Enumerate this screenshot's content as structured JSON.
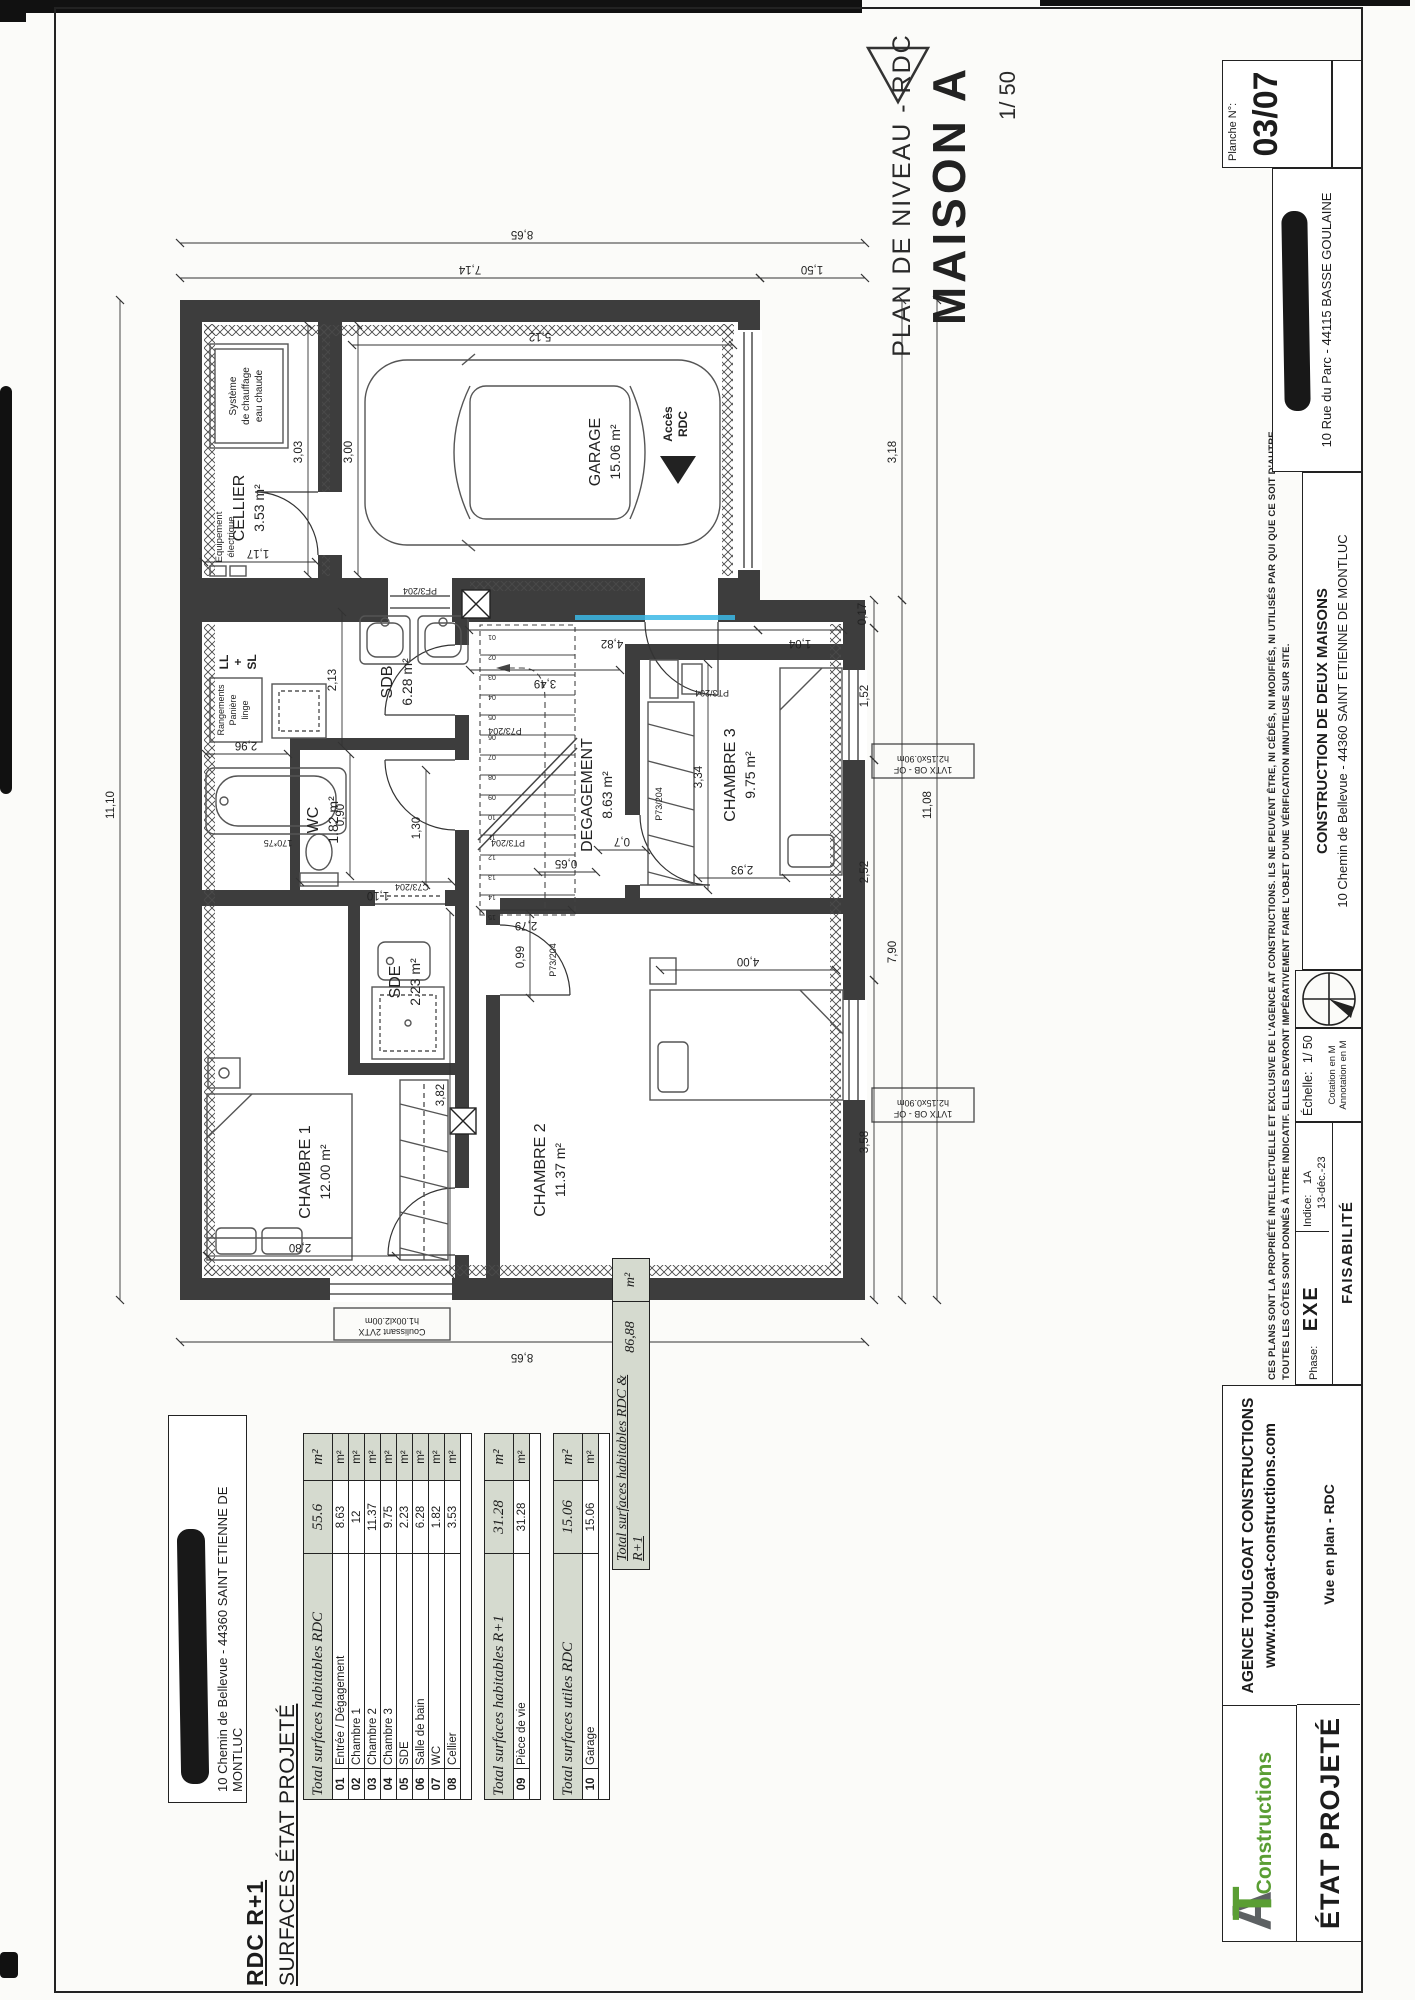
{
  "page": {
    "title_line": "PLAN DE NIVEAU - RDC",
    "title_main": "MAISON A",
    "scale": "1/ 50",
    "planche_label": "Planche N°:",
    "planche_no": "03/07",
    "agency_address": "10 Rue du Parc - 44115 BASSE GOULAINE"
  },
  "title_block": {
    "agency_name": "AGENCE TOULGOAT CONSTRUCTIONS",
    "agency_site": "www.toulgoat-constructions.com",
    "logo_a": "A",
    "logo_t": "T",
    "logo_text": "Constructions",
    "etat": "ÉTAT PROJETÉ",
    "vue": "Vue en plan - RDC",
    "phase_label": "Phase:",
    "phase": "EXE",
    "status": "FAISABILITÉ",
    "indice_label": "Indice:",
    "indice": "1A",
    "indice_date": "13-déc.-23",
    "echelle_label": "Échelle:",
    "echelle": "1/ 50",
    "cotation": "Cotation en M",
    "annotation": "Annotation en M",
    "project_title": "CONSTRUCTION DE DEUX MAISONS",
    "project_address": "10 Chemin de Bellevue - 44360 SAINT ETIENNE DE MONTLUC",
    "disclaimer1": "CES PLANS SONT LA PROPRIÉTÉ INTELLECTUELLE ET EXCLUSIVE DE L'AGENCE AT CONSTRUCTIONS. ILS NE PEUVENT ÊTRE, NI CÉDÉS, NI MODIFIÉS, NI UTILISÉS PAR QUI QUE CE SOIT D'AUTRE.",
    "disclaimer2": "TOUTES LES CÔTES SONT DONNÉS À TITRE INDICATIF. ELLES DEVRONT IMPÉRATIVEMENT FAIRE L'OBJET D'UNE VÉRIFICATION MINUTIEUSE SUR SITE."
  },
  "surfaces": {
    "heading1": "RDC  R+1",
    "heading2": "SURFACES ÉTAT PROJETÉ",
    "client_address": "10 Chemin de Bellevue - 44360 SAINT ETIENNE DE MONTLUC",
    "tables": [
      {
        "title": "Total surfaces habitables RDC",
        "total": "55.6",
        "unit": "m²",
        "rows": [
          {
            "num": "01",
            "label": "Entrée / Dégagement",
            "value": "8.63",
            "unit": "m²"
          },
          {
            "num": "02",
            "label": "Chambre 1",
            "value": "12",
            "unit": "m²"
          },
          {
            "num": "03",
            "label": "Chambre 2",
            "value": "11.37",
            "unit": "m²"
          },
          {
            "num": "04",
            "label": "Chambre 3",
            "value": "9.75",
            "unit": "m²"
          },
          {
            "num": "05",
            "label": "SDE",
            "value": "2.23",
            "unit": "m²"
          },
          {
            "num": "06",
            "label": "Salle de bain",
            "value": "6.28",
            "unit": "m²"
          },
          {
            "num": "07",
            "label": "WC",
            "value": "1.82",
            "unit": "m²"
          },
          {
            "num": "08",
            "label": "Cellier",
            "value": "3.53",
            "unit": "m²"
          }
        ]
      },
      {
        "title": "Total surfaces habitables R+1",
        "total": "31.28",
        "unit": "m²",
        "rows": [
          {
            "num": "09",
            "label": "Pièce de vie",
            "value": "31.28",
            "unit": "m²"
          }
        ]
      },
      {
        "title": "Total surfaces utiles RDC",
        "total": "15.06",
        "unit": "m²",
        "rows": [
          {
            "num": "10",
            "label": "Garage",
            "value": "15.06",
            "unit": "m²"
          }
        ]
      }
    ],
    "grand_total": {
      "label": "Total surfaces habitables RDC & R+1",
      "value": "86,88",
      "unit": "m²"
    }
  },
  "plan": {
    "rooms": [
      {
        "id": "cellier",
        "name": "CELLIER",
        "area": "3.53 m²"
      },
      {
        "id": "garage",
        "name": "GARAGE",
        "area": "15.06 m²"
      },
      {
        "id": "sdb",
        "name": "SDB",
        "area": "6.28 m²"
      },
      {
        "id": "wc",
        "name": "WC",
        "area": "1.82 m²"
      },
      {
        "id": "sde",
        "name": "SDE",
        "area": "2.23 m²"
      },
      {
        "id": "degagement",
        "name": "DEGAGEMENT",
        "area": "8.63 m²"
      },
      {
        "id": "ch1",
        "name": "CHAMBRE 1",
        "area": "12.00 m²"
      },
      {
        "id": "ch2",
        "name": "CHAMBRE 2",
        "area": "11.37 m²"
      },
      {
        "id": "ch3",
        "name": "CHAMBRE 3",
        "area": "9.75 m²"
      }
    ],
    "dims": [
      {
        "id": "d1110",
        "label": "11,10"
      },
      {
        "id": "d865R",
        "label": "8,65"
      },
      {
        "id": "d714",
        "label": "7,14"
      },
      {
        "id": "d150",
        "label": "1,50"
      },
      {
        "id": "d865L",
        "label": "8,65"
      },
      {
        "id": "d1108",
        "label": "11,08"
      },
      {
        "id": "d790",
        "label": "7,90"
      },
      {
        "id": "d318",
        "label": "3,18"
      },
      {
        "id": "d358",
        "label": "3,58"
      },
      {
        "id": "d252",
        "label": "2,52"
      },
      {
        "id": "d152",
        "label": "1,52"
      },
      {
        "id": "d017",
        "label": "0,17"
      },
      {
        "id": "d512",
        "label": "5,12"
      },
      {
        "id": "d300",
        "label": "3,00"
      },
      {
        "id": "d303",
        "label": "3,03"
      },
      {
        "id": "d117",
        "label": "1,17"
      },
      {
        "id": "d213",
        "label": "2,13"
      },
      {
        "id": "d296",
        "label": "2,96"
      },
      {
        "id": "d090",
        "label": "0,90"
      },
      {
        "id": "d110",
        "label": "1,10"
      },
      {
        "id": "d280",
        "label": "2,80"
      },
      {
        "id": "d382",
        "label": "3,82"
      },
      {
        "id": "d130",
        "label": "1,30"
      },
      {
        "id": "d279",
        "label": "2,79"
      },
      {
        "id": "d349",
        "label": "3,49"
      },
      {
        "id": "d482",
        "label": "4,82"
      },
      {
        "id": "d104",
        "label": "1,04"
      },
      {
        "id": "d099",
        "label": "0,99"
      },
      {
        "id": "d065",
        "label": "0,65"
      },
      {
        "id": "d07",
        "label": "0,7"
      },
      {
        "id": "d293",
        "label": "2,93"
      },
      {
        "id": "d334",
        "label": "3,34"
      },
      {
        "id": "d400",
        "label": "4,00"
      }
    ],
    "door_labels": [
      {
        "id": "pf3",
        "label": "PF3/204"
      },
      {
        "id": "p73sdb",
        "label": "P73/204"
      },
      {
        "id": "pt3wc",
        "label": "PT3/204"
      },
      {
        "id": "c73sde",
        "label": "C73/204"
      },
      {
        "id": "p73ch2",
        "label": "P73/204"
      },
      {
        "id": "p73ch3",
        "label": "P73/204"
      },
      {
        "id": "pt3ch3",
        "label": "PT3/204"
      }
    ],
    "window_labels": [
      {
        "id": "w1",
        "lines": [
          "1VTX OB - OF",
          "h2.15x0.90m"
        ]
      },
      {
        "id": "w2",
        "lines": [
          "1VTX OB - OF",
          "h2.15x0.90m"
        ]
      },
      {
        "id": "coul",
        "lines": [
          "Coulissant 2VTX",
          "h1.00xl2.00m"
        ]
      }
    ],
    "annotations": {
      "acces": [
        "Accès",
        "RDC"
      ],
      "heater": [
        "Système",
        "de chauffage",
        "eau chaude"
      ],
      "elec": [
        "Equipement",
        "électrique"
      ],
      "rangements": [
        "Rangements",
        "Panière",
        "linge"
      ],
      "llsl": [
        "LL",
        "+",
        "SL"
      ],
      "tub_size": "170*75"
    },
    "stair_numbers": [
      "01",
      "02",
      "03",
      "04",
      "05",
      "06",
      "07",
      "08",
      "09",
      "10",
      "11",
      "12",
      "13",
      "14",
      "15"
    ]
  },
  "colors": {
    "wall": "#3d3d3d",
    "accent_green": "#5a9e33",
    "highlight_blue": "#3bb9e6",
    "shade": "#d5dacf"
  }
}
